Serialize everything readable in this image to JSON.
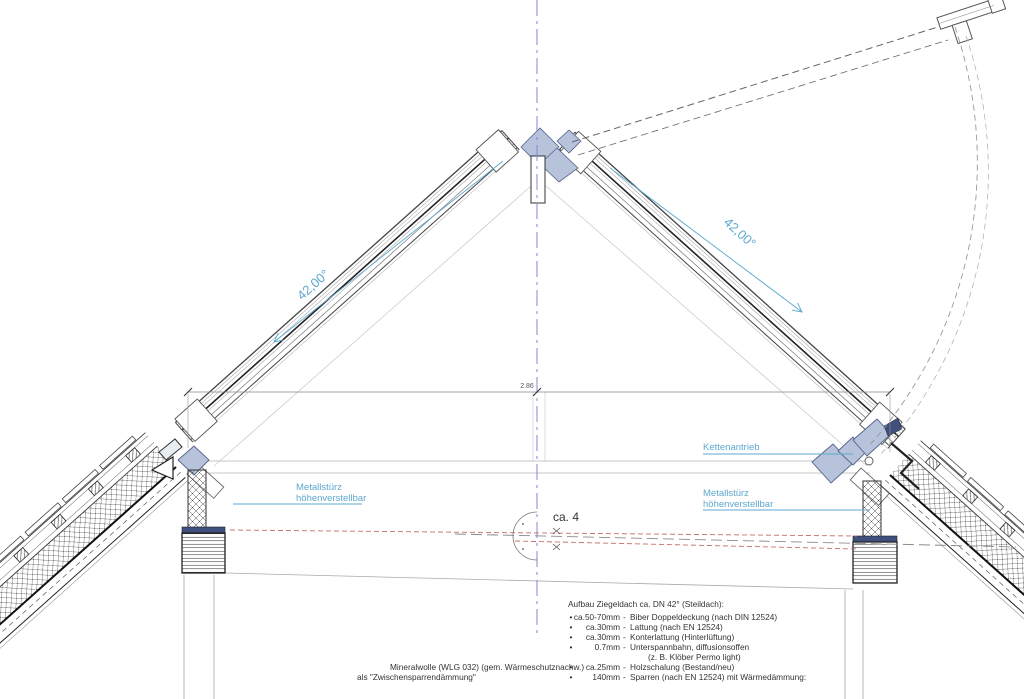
{
  "annotations": {
    "angle_left": "42,00°",
    "angle_right": "42,00°",
    "ridge_dimension": "2.86",
    "floor_slope": "ca. 4",
    "kettenantrieb": "Kettenantrieb",
    "metallsturz_left_line1": "Metallstürz",
    "metallsturz_left_line2": "höhenverstellbar",
    "metallsturz_right_line1": "Metallstürz",
    "metallsturz_right_line2": "höhenverstellbar"
  },
  "insulation_note": {
    "line1": "Mineralwolle (WLG 032) (gem. Wärmeschutznachw.)",
    "line2": "als \"Zwischensparrendämmung\""
  },
  "spec": {
    "title": "Aufbau Ziegeldach ca. DN 42° (Steildach):",
    "items": [
      {
        "bullet": "•",
        "measure": "ca.50-70mm",
        "sep": "-",
        "desc": "Biber Doppeldeckung (nach DIN 12524)"
      },
      {
        "bullet": "•",
        "measure": "ca.30mm",
        "sep": "-",
        "desc": "Lattung (nach EN 12524)"
      },
      {
        "bullet": "•",
        "measure": "ca.30mm",
        "sep": "-",
        "desc": "Konterlattung (Hinterlüftung)"
      },
      {
        "bullet": "•",
        "measure": "0.7mm",
        "sep": "-",
        "desc": "Unterspannbahn, diffusionsoffen"
      },
      {
        "bullet": "",
        "measure": "",
        "sep": "",
        "desc": "(z. B. Klöber Permo light)"
      },
      {
        "bullet": "•",
        "measure": "ca.25mm",
        "sep": "-",
        "desc": "Holzschalung (Bestand/neu)"
      },
      {
        "bullet": "•",
        "measure": "140mm",
        "sep": "-",
        "desc": "Sparren (nach EN 12524) mit Wärmedämmung:"
      }
    ]
  },
  "colors": {
    "annotation_blue": "#5fa8cf",
    "centerline_blue": "#8585d6",
    "fill_bluegray": "#b6c3da",
    "fill_navy": "#3f4f7e",
    "red_dashed": "#c4706a"
  }
}
